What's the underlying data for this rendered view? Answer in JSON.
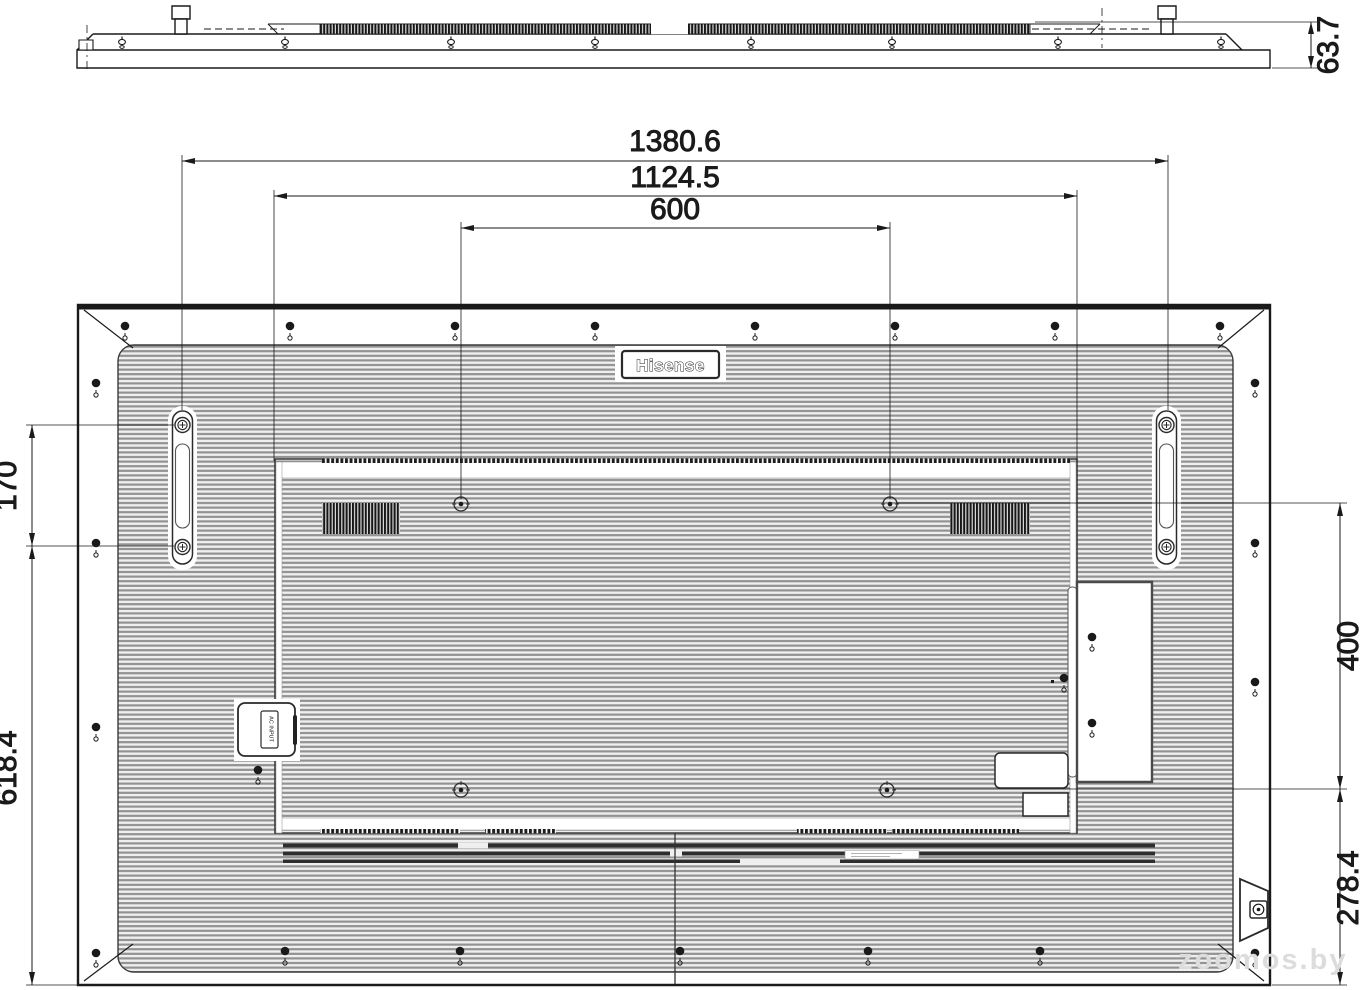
{
  "drawing": {
    "brand_logo": "Hisense",
    "ac_input_label": "AC INPUT",
    "watermark": "zoomos.by"
  },
  "dims": {
    "depth": "63.7",
    "overall_width": "1380.6",
    "mount_area_width": "1124.5",
    "vesa_width": "600",
    "handle_span": "170",
    "lower_height": "618.4",
    "vesa_height": "400",
    "bottom_offset": "278.4"
  }
}
